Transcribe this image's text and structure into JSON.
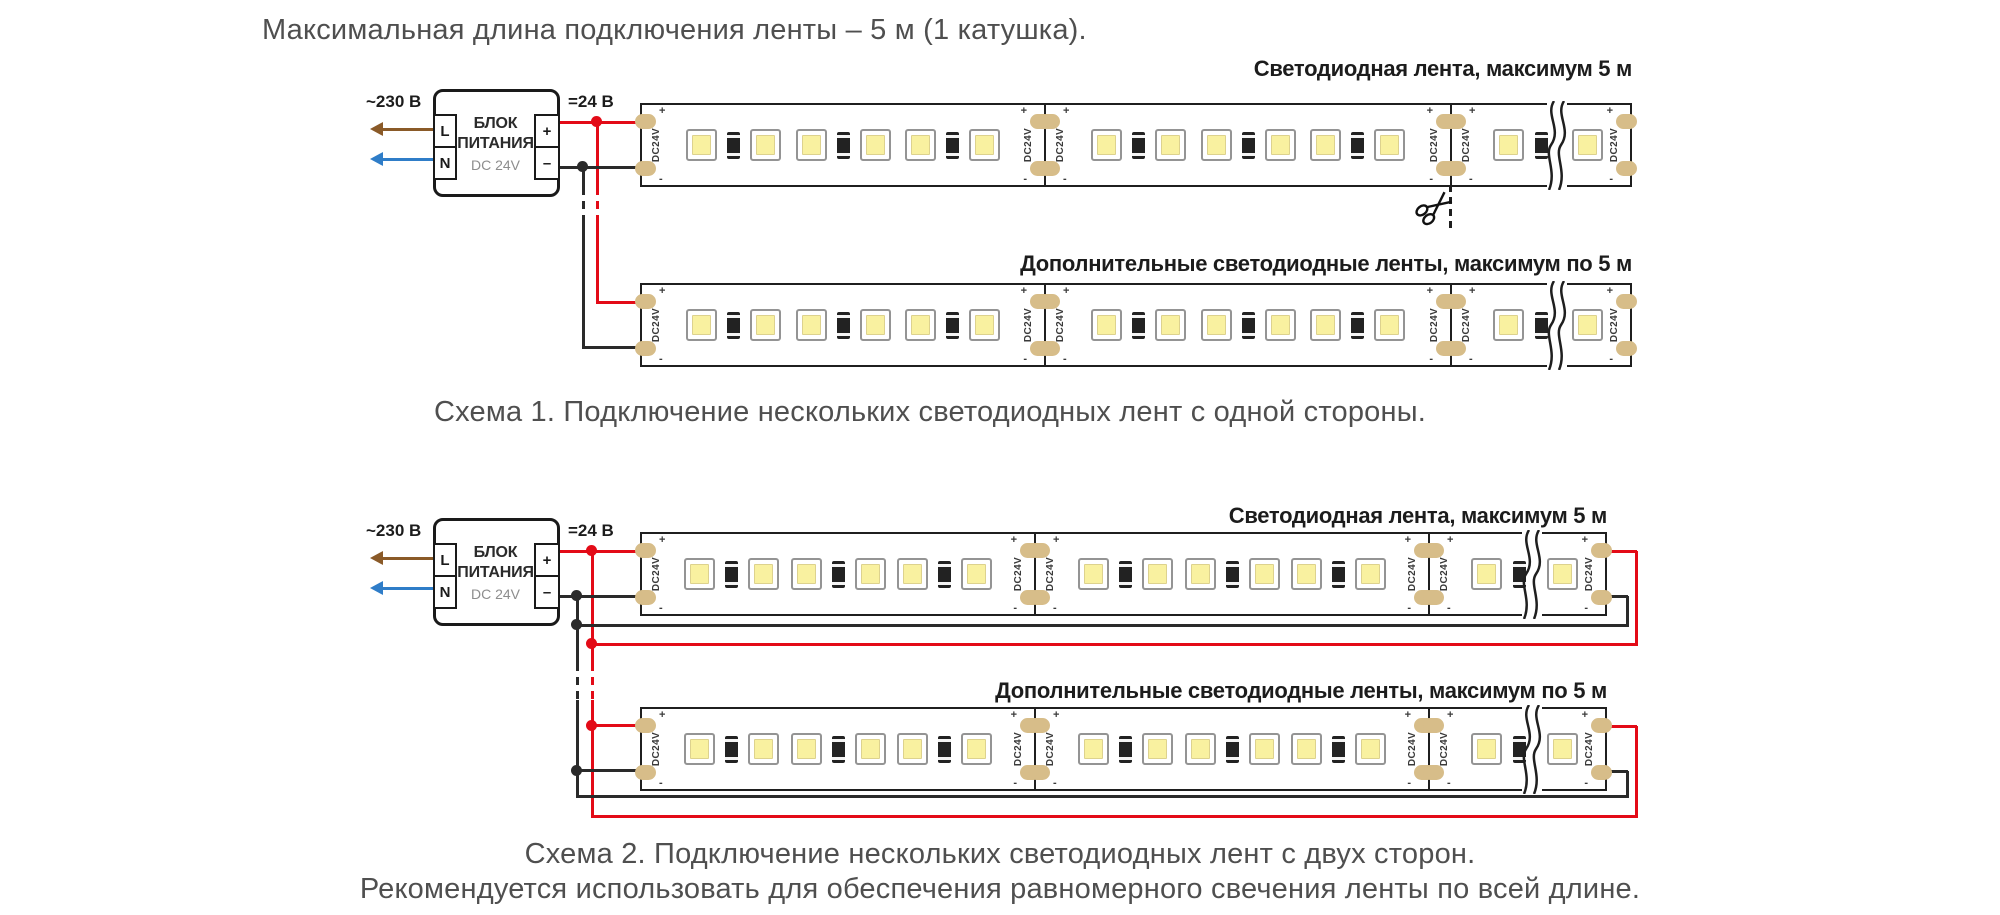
{
  "title": "Максимальная длина подключения ленты – 5 м (1 катушка).",
  "psu": {
    "input_voltage": "~230 В",
    "output_voltage": "=24 В",
    "name_line1": "БЛОК",
    "name_line2": "ПИТАНИЯ",
    "model": "DC 24V",
    "terminal_l": "L",
    "terminal_n": "N",
    "terminal_plus": "+",
    "terminal_minus": "–"
  },
  "strip": {
    "pad_label": "DC24V",
    "pad_plus": "+",
    "pad_minus": "-",
    "groups_per_segment": 3,
    "leds_per_group": 2,
    "resistors_per_group": 1
  },
  "scheme1": {
    "main_strip_label": "Светодиодная лента, максимум 5 м",
    "additional_strip_label": "Дополнительные светодиодные ленты, максимум по 5 м",
    "caption": "Схема 1. Подключение нескольких светодиодных лент с одной стороны."
  },
  "scheme2": {
    "main_strip_label": "Светодиодная лента, максимум 5 м",
    "additional_strip_label": "Дополнительные светодиодные ленты, максимум по 5 м",
    "caption_line1": "Схема 2. Подключение нескольких светодиодных лент с двух сторон.",
    "caption_line2": "Рекомендуется использовать для обеспечения равномерного свечения ленты по всей длине."
  },
  "colors": {
    "wire_positive": "#e30b17",
    "wire_negative": "#2a2a2a",
    "phase_arrow": "#8a5a28",
    "neutral_arrow": "#2f7dc8",
    "solder_pad": "#d7bd89",
    "led_fill": "#f9f1a0"
  }
}
